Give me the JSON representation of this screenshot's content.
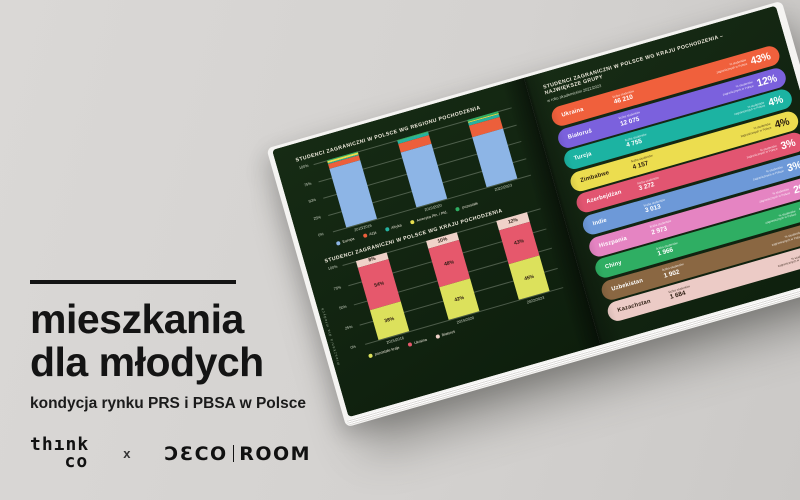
{
  "cover": {
    "title_line1": "mieszkania",
    "title_line2": "dla młodych",
    "subtitle": "kondycja rynku PRS i PBSA w Polsce",
    "logos": {
      "thinkco_line1": "thınk",
      "thinkco_line2": "co",
      "separator": "x",
      "decoroom_left": "ƆƐCO",
      "decoroom_right": "ROOM"
    },
    "text_color": "#141414",
    "background_color": "#d6d4d2"
  },
  "book": {
    "page_background": "#122411",
    "left_page": {
      "side_caption": "mieszkania dla młodych"
    }
  },
  "chart_data": [
    {
      "id": "regions",
      "type": "bar",
      "stacked": true,
      "title": "STUDENCI ZAGRANICZNI W POLSCE WG REGIONU POCHODZENIA",
      "categories": [
        "2015/2016",
        "2019/2020",
        "2022/2023"
      ],
      "series": [
        {
          "name": "Europa",
          "color": "#8db5e6",
          "values": [
            87,
            82,
            74
          ]
        },
        {
          "name": "Azja",
          "color": "#ec5f3b",
          "values": [
            8,
            13,
            17
          ]
        },
        {
          "name": "Afryka",
          "color": "#25b2a1",
          "values": [
            1,
            3,
            5
          ]
        },
        {
          "name": "Ameryka Płn. i Płd.",
          "color": "#e7df4e",
          "values": [
            2,
            1,
            1
          ]
        },
        {
          "name": "pozostałe",
          "color": "#2fae63",
          "values": [
            2,
            1,
            3
          ]
        }
      ],
      "yticks": [
        "100%",
        "75%",
        "50%",
        "25%",
        "0%"
      ],
      "ylim": [
        0,
        100
      ],
      "grid": true,
      "legend_position": "bottom",
      "show_segment_labels": false
    },
    {
      "id": "countries-share",
      "type": "bar",
      "stacked": true,
      "title": "STUDENCI ZAGRANICZNI W POLSCE WG KRAJU POCHODZENIA",
      "categories": [
        "2015/2016",
        "2019/2020",
        "2022/2023"
      ],
      "series": [
        {
          "name": "pozostałe kraje",
          "color": "#dce15c",
          "values": [
            38,
            42,
            45
          ]
        },
        {
          "name": "Ukraina",
          "color": "#e6586c",
          "values": [
            54,
            48,
            43
          ]
        },
        {
          "name": "Białoruś",
          "color": "#f0d2c9",
          "values": [
            8,
            10,
            12
          ]
        }
      ],
      "yticks": [
        "100%",
        "75%",
        "50%",
        "25%",
        "0%"
      ],
      "ylim": [
        0,
        100
      ],
      "grid": true,
      "legend_position": "bottom",
      "show_segment_labels": true,
      "segment_label_format": [
        "38%",
        "54%",
        "8%",
        "42%",
        "48%",
        "10%",
        "45%",
        "43%",
        "12%"
      ]
    },
    {
      "id": "top-countries",
      "type": "bar",
      "orientation": "horizontal",
      "title": "STUDENCI ZAGRANICZNI W POLSCE WG KRAJU POCHODZENIA – NAJWIĘKSZE GRUPY",
      "subtitle": "w roku akademickim 2022/2023",
      "value_caption": "liczba studentów",
      "pct_caption": "% studentów zagranicznych w Polsce",
      "rows": [
        {
          "country": "Ukraina",
          "value": "46 210",
          "pct": "43%",
          "color": "#f0603c",
          "text": "light"
        },
        {
          "country": "Białoruś",
          "value": "12 075",
          "pct": "12%",
          "color": "#7b61dd",
          "text": "light"
        },
        {
          "country": "Turcja",
          "value": "4 755",
          "pct": "4%",
          "color": "#1cb3a2",
          "text": "light"
        },
        {
          "country": "Zimbabwe",
          "value": "4 157",
          "pct": "4%",
          "color": "#ecdd4f",
          "text": "dark"
        },
        {
          "country": "Azerbejdżan",
          "value": "3 272",
          "pct": "3%",
          "color": "#e25571",
          "text": "light"
        },
        {
          "country": "Indie",
          "value": "3 013",
          "pct": "3%",
          "color": "#6d99d8",
          "text": "light"
        },
        {
          "country": "Hiszpania",
          "value": "2 973",
          "pct": "2%",
          "color": "#e584c2",
          "text": "light"
        },
        {
          "country": "Chiny",
          "value": "1 966",
          "pct": "2%",
          "color": "#2fae63",
          "text": "light"
        },
        {
          "country": "Uzbekistan",
          "value": "1 902",
          "pct": "2%",
          "color": "#8a6742",
          "text": "light"
        },
        {
          "country": "Kazachstan",
          "value": "1 684",
          "pct": "2%",
          "color": "#eccbc6",
          "text": "dark"
        }
      ]
    }
  ]
}
